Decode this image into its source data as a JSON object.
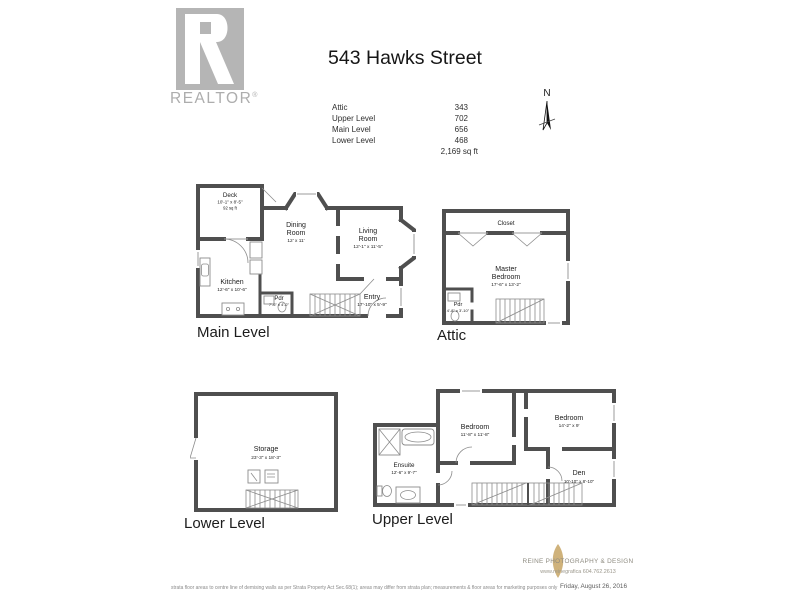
{
  "colors": {
    "wall": "#4f4f4f",
    "logo_grey": "#b5b5b5",
    "leaf_gold": "#c7a464"
  },
  "header": {
    "title": "543 Hawks Street",
    "logo_text": "REALTOR",
    "logo_reg": "®"
  },
  "area_summary": {
    "rows": [
      {
        "label": "Attic",
        "value": "343"
      },
      {
        "label": "Upper Level",
        "value": "702"
      },
      {
        "label": "Main Level",
        "value": "656"
      },
      {
        "label": "Lower Level",
        "value": "468"
      }
    ],
    "total": "2,169 sq ft"
  },
  "compass": {
    "label": "N"
  },
  "plans": {
    "main_level": {
      "label": "Main Level",
      "deck": {
        "name": "Deck",
        "dims": "10'-1\" x 8'-5\"",
        "area": "92 sq ft"
      },
      "dining": {
        "line1": "Dining",
        "line2": "Room",
        "dims": "12' x 11'"
      },
      "living": {
        "line1": "Living",
        "line2": "Room",
        "dims": "12'-1\" x 11'-5\""
      },
      "kitchen": {
        "name": "Kitchen",
        "dims": "12'-6\" x 10'-6\""
      },
      "pdr": {
        "name": "Pdr",
        "dims": "7'-6\" x 4'-2\""
      },
      "entry": {
        "name": "Entry",
        "dims": "17'-10\" x 5'-9\""
      }
    },
    "attic": {
      "label": "Attic",
      "closet": {
        "name": "Closet"
      },
      "master": {
        "line1": "Master",
        "line2": "Bedroom",
        "dims": "17'-6\" x 13'-2\""
      },
      "pdr": {
        "name": "Pdr",
        "dims": "4'-8\" x 3'-10\""
      }
    },
    "lower_level": {
      "label": "Lower Level",
      "storage": {
        "name": "Storage",
        "dims": "23'-3\" x 18'-3\""
      }
    },
    "upper_level": {
      "label": "Upper Level",
      "bedroom1": {
        "name": "Bedroom",
        "dims": "11'-8\" x 11'-8\""
      },
      "bedroom2": {
        "name": "Bedroom",
        "dims": "14'-2\" x 9'"
      },
      "ensuite": {
        "name": "Ensuite",
        "dims": "12'-6\" x 9'-7\""
      },
      "den": {
        "name": "Den",
        "dims": "10'-10\" x 8'-10\""
      }
    }
  },
  "footer": {
    "disclaimer": "strata floor areas to centre line of demising walls as per Strata Property Act Sec.68(1); areas may differ from strata plan; measurements & floor areas for marketing purposes only",
    "credit_name": "REINE PHOTOGRAPHY & DESIGN",
    "credit_contact": "www.reinegrafica  604.762.2613",
    "credit_date": "Friday, August 26, 2016"
  }
}
